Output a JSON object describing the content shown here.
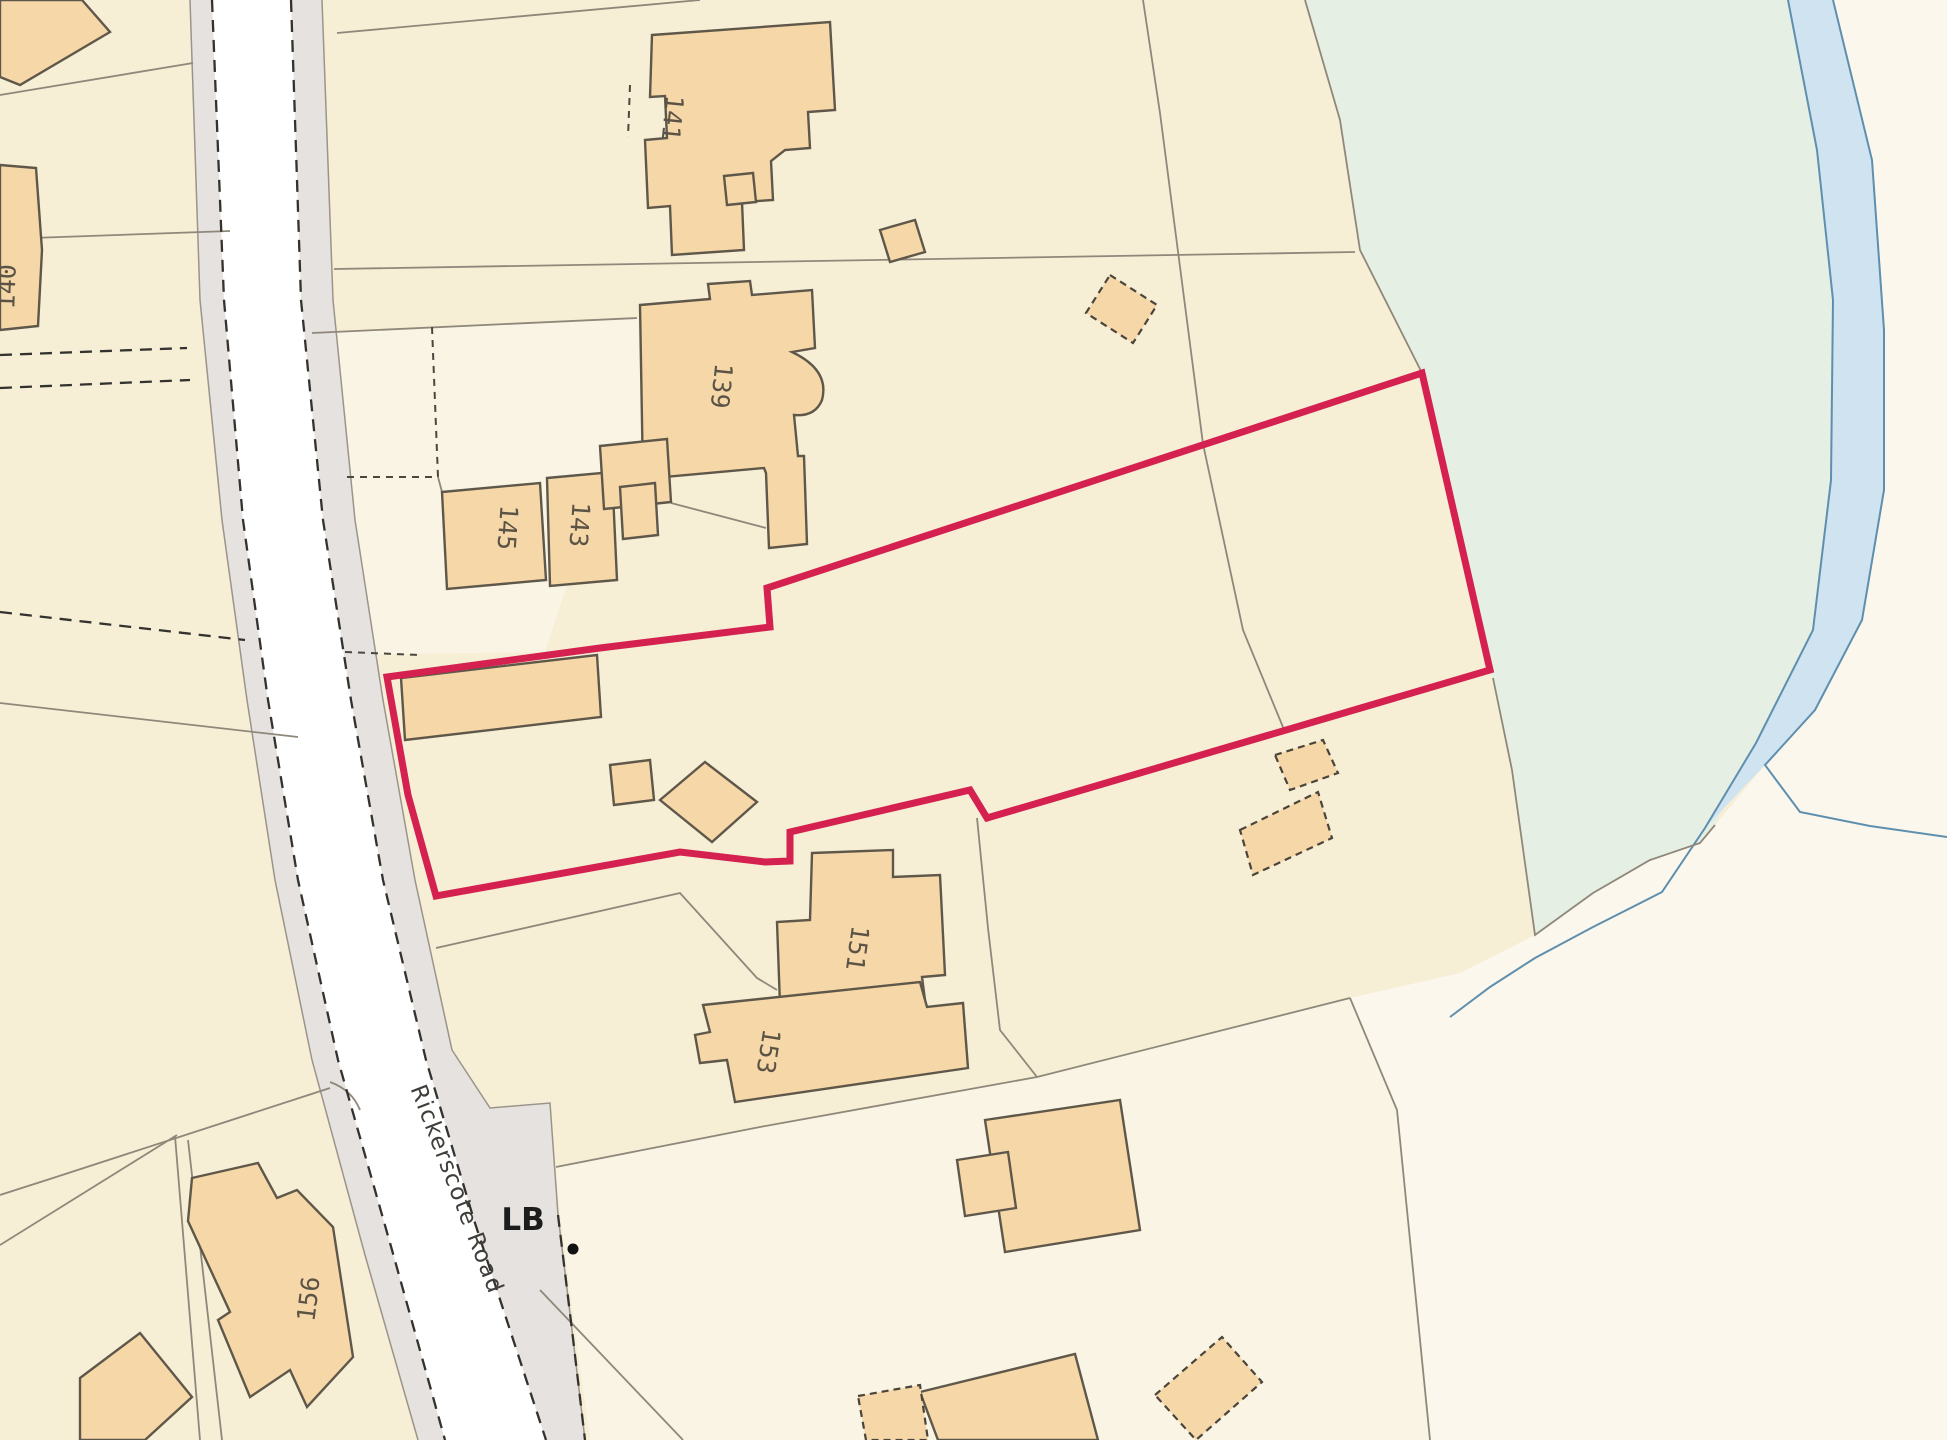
{
  "road": {
    "name": "Rickerscote Road",
    "lb_marker": "LB"
  },
  "house_numbers": {
    "139": "139",
    "140": "140",
    "141": "141",
    "143": "143",
    "145": "145",
    "151": "151",
    "153": "153",
    "156": "156"
  },
  "colors": {
    "base_land": "#f6eed5",
    "light_land": "#f9f4e3",
    "building_fill": "#f6d7a8",
    "building_stroke": "#5f584a",
    "parcel_line": "#8f887a",
    "road_surface": "#ffffff",
    "pavement": "#e6e2df",
    "boundary_red": "#d42150",
    "green_space": "#e6efe3",
    "pale_land": "#fbf7ec",
    "water_fill": "#cfe3f1",
    "water_line": "#5e8fae",
    "dash_line": "#33322e",
    "label_text": "#5a5346",
    "lb_text": "#1c1c1c"
  }
}
